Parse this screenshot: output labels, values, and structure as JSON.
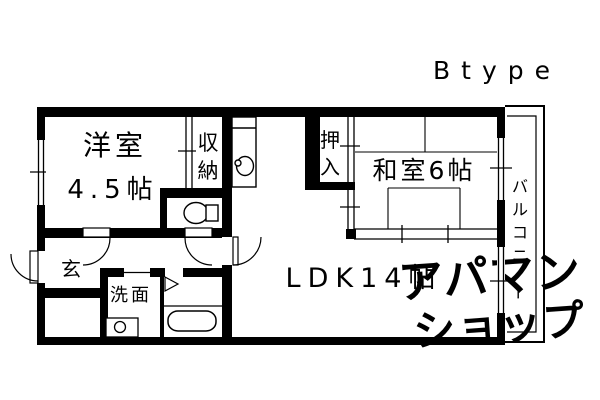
{
  "title": "Btype",
  "watermark": {
    "line1": "アパマン",
    "line2": "ショップ"
  },
  "colors": {
    "line": "#000000",
    "background": "#ffffff",
    "watermark": "#e0e0e0"
  },
  "plan": {
    "rooms": {
      "youshitsu": {
        "name": "洋室",
        "size": "4.5帖"
      },
      "shuunou": {
        "label": "収納"
      },
      "oshiire": {
        "label": "押入"
      },
      "washitsu": {
        "label": "和室6帖"
      },
      "ldk": {
        "label": "LDK14帖"
      },
      "genkan": {
        "label": "玄"
      },
      "senmen": {
        "label": "洗面"
      },
      "balcony": {
        "label": "バルコニー"
      }
    },
    "fixtures": [
      "toilet-icon",
      "kitchen-sink-icon",
      "washbasin-icon",
      "bathtub-icon"
    ]
  }
}
